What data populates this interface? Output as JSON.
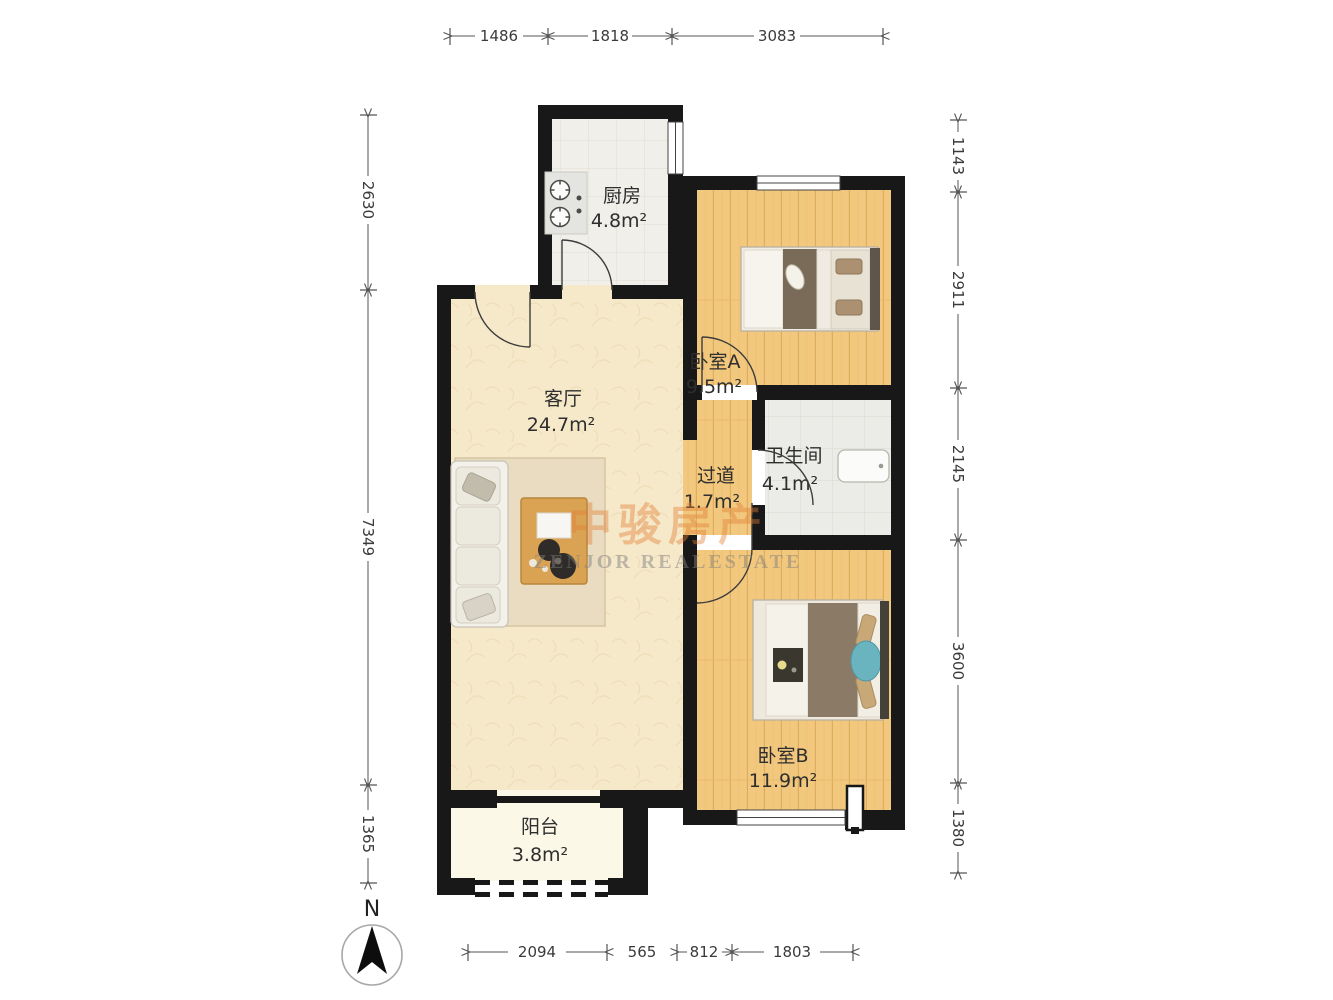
{
  "plan": {
    "rooms": [
      {
        "id": "kitchen",
        "name": "厨房",
        "area": "4.8m²"
      },
      {
        "id": "bedroom-a",
        "name": "卧室A",
        "area": "9.5m²"
      },
      {
        "id": "living-room",
        "name": "客厅",
        "area": "24.7m²"
      },
      {
        "id": "hallway",
        "name": "过道",
        "area": "1.7m²"
      },
      {
        "id": "bathroom",
        "name": "卫生间",
        "area": "4.1m²"
      },
      {
        "id": "bedroom-b",
        "name": "卧室B",
        "area": "11.9m²"
      },
      {
        "id": "balcony",
        "name": "阳台",
        "area": "3.8m²"
      }
    ],
    "dimensions_mm": {
      "top": [
        "1486",
        "1818",
        "3083"
      ],
      "left": [
        "2630",
        "7349",
        "1365"
      ],
      "right": [
        "1143",
        "2911",
        "2145",
        "3600",
        "1380"
      ],
      "bottom": [
        "2094",
        "565",
        "812",
        "1803"
      ]
    },
    "compass": {
      "label": "N"
    },
    "watermark": {
      "line1": "中骏房产",
      "line2": "ZENJOR REALESTATE"
    },
    "colors": {
      "wall": "#181818",
      "wood_floor": "#f2c87e",
      "living_floor": "#f6e9c9",
      "kitchen_floor": "#f0efe9",
      "bath_floor": "#ebebe7",
      "balcony_floor": "#fcf8e8",
      "watermark_orange": "#e07e34"
    }
  }
}
